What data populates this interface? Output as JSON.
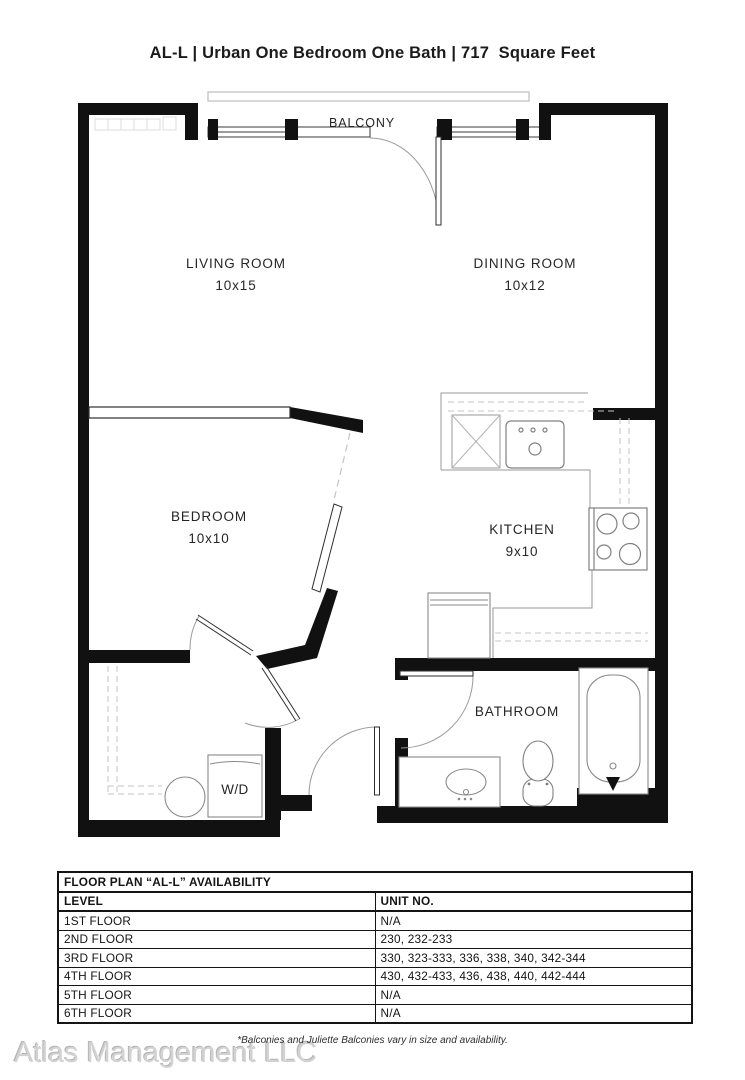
{
  "header": {
    "title": "AL-L | Urban One Bedroom One Bath | 717  Square Feet"
  },
  "plan": {
    "balcony": "BALCONY",
    "living": {
      "name": "LIVING ROOM",
      "dims": "10x15"
    },
    "dining": {
      "name": "DINING ROOM",
      "dims": "10x12"
    },
    "bedroom": {
      "name": "BEDROOM",
      "dims": "10x10"
    },
    "kitchen": {
      "name": "KITCHEN",
      "dims": "9x10"
    },
    "bathroom": {
      "name": "BATHROOM"
    },
    "laundry": {
      "name": "W/D"
    }
  },
  "availability": {
    "title": "FLOOR PLAN “AL-L” AVAILABILITY",
    "columns": {
      "level": "LEVEL",
      "unit": "UNIT NO."
    },
    "rows": [
      {
        "level": "1ST FLOOR",
        "units": "N/A"
      },
      {
        "level": "2ND FLOOR",
        "units": "230, 232-233"
      },
      {
        "level": "3RD FLOOR",
        "units": "330, 323-333, 336, 338, 340, 342-344"
      },
      {
        "level": "4TH FLOOR",
        "units": "430, 432-433, 436, 438, 440, 442-444"
      },
      {
        "level": "5TH FLOOR",
        "units": "N/A"
      },
      {
        "level": "6TH FLOOR",
        "units": "N/A"
      }
    ]
  },
  "footer": {
    "disclaimer": "*Balconies and Juliette Balconies vary in size and availability.",
    "watermark": "Atlas Management LLC"
  },
  "colors": {
    "wall": "#111111",
    "fixture": "#8a8a8a",
    "dashed": "#c4c4c4"
  }
}
